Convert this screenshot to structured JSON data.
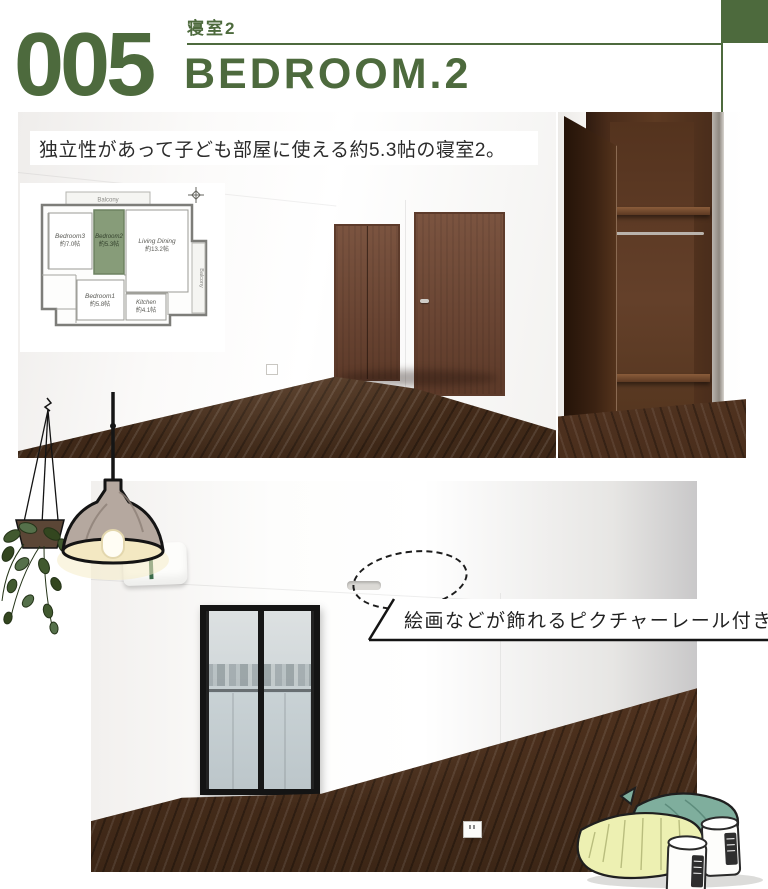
{
  "theme": {
    "accent_green": "#4d6a3d",
    "room_highlight_green": "#879c79",
    "caption_text_color": "#2b2b2b",
    "wood_brown": "#553621"
  },
  "header": {
    "index_number": "005",
    "label_ja": "寝室2",
    "title_en": "BEDROOM.2"
  },
  "main_caption": {
    "text": "独立性があって子ども部屋に使える約5.3帖の寝室2。"
  },
  "rail_caption": {
    "text": "絵画などが飾れるピクチャーレール付き。"
  },
  "floorplan": {
    "balcony_top": "Balcony",
    "balcony_right": "Balcony",
    "rooms": [
      {
        "name": "Bedroom3",
        "size": "約7.0帖"
      },
      {
        "name": "Bedroom2",
        "size": "約5.3帖"
      },
      {
        "name": "Living Dining",
        "size": "約13.2帖"
      },
      {
        "name": "Bedroom1",
        "size": "約5.8帖"
      },
      {
        "name": "Kitchen",
        "size": "約4.1帖"
      }
    ]
  },
  "icons": {
    "compass": "compass-icon",
    "hanging_plant": "hanging-plant-illustration",
    "pendant_lamp": "pendant-lamp-illustration",
    "pillows_jars": "pillows-and-jars-illustration",
    "picture_rail_marker": "dashed-ellipse-marker"
  }
}
